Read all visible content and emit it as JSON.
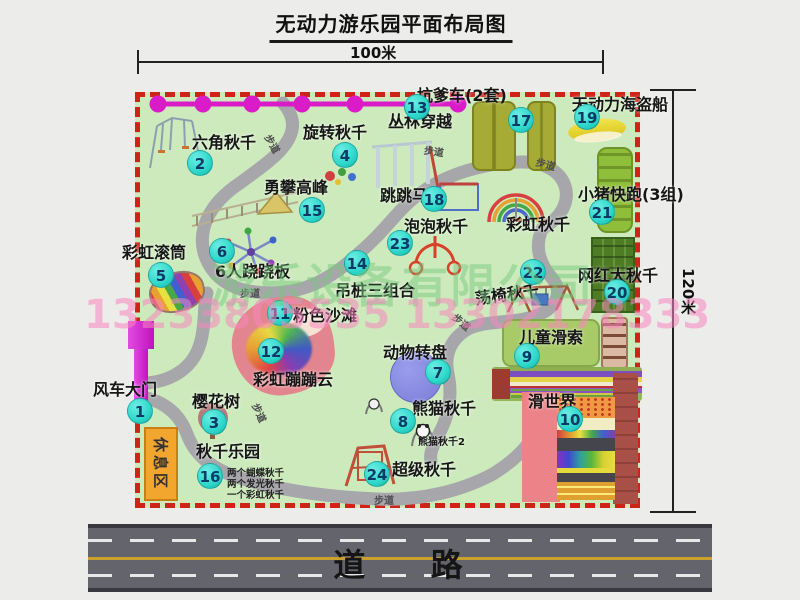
{
  "title": "无动力游乐园平面布局图",
  "dimensions": {
    "width": "100米",
    "height": "120米"
  },
  "road": {
    "label": "道 路"
  },
  "walkway_label": "步道",
  "watermark": {
    "company": "游乐设备有限公司",
    "phones": "13233805535 13302178333"
  },
  "rest_area": {
    "label": "休息区"
  },
  "colors": {
    "park_green": "#cdeabd",
    "border_red": "#cf2318",
    "badge_bg": "#2ed7cb",
    "badge_text": "#0a3a66",
    "road_gray": "#64646c",
    "magenta": "#da1cc8",
    "rest_orange": "#f2a62e",
    "walkway_gray": "#a7a7ab"
  },
  "pois": [
    {
      "id": "windmill-gate",
      "num": "1",
      "label": "风车大门"
    },
    {
      "id": "hex-swing",
      "num": "2",
      "label": "六角秋千"
    },
    {
      "id": "cherry-tree",
      "num": "3",
      "label": "樱花树"
    },
    {
      "id": "spin-swing",
      "num": "4",
      "label": "旋转秋千"
    },
    {
      "id": "rainbow-roller",
      "num": "5",
      "label": "彩虹滚筒"
    },
    {
      "id": "seesaw-6p",
      "num": "6",
      "label": "6人跷跷板"
    },
    {
      "id": "animal-turntable",
      "num": "7",
      "label": "动物转盘"
    },
    {
      "id": "panda-swing",
      "num": "8",
      "label": "熊猫秋千"
    },
    {
      "id": "kids-zipline",
      "num": "9",
      "label": "儿童滑索"
    },
    {
      "id": "slide-world",
      "num": "10",
      "label": "滑世界"
    },
    {
      "id": "pink-beach",
      "num": "11",
      "label": "粉色沙滩"
    },
    {
      "id": "rainbow-cloud",
      "num": "12",
      "label": "彩虹蹦蹦云"
    },
    {
      "id": "jungle-crossing",
      "num": "13",
      "label": "丛林穿越"
    },
    {
      "id": "hanging-posts",
      "num": "14",
      "label": "吊桩三组合"
    },
    {
      "id": "brave-climb",
      "num": "15",
      "label": "勇攀高峰"
    },
    {
      "id": "swing-park",
      "num": "16",
      "label": "秋千乐园",
      "notes": [
        "两个蝴蝶秋千",
        "两个发光秋千",
        "一个彩虹秋千"
      ]
    },
    {
      "id": "pit-cars",
      "num": "17",
      "label": "坑爹车(2套)"
    },
    {
      "id": "jump-horse",
      "num": "18",
      "label": "跳跳马"
    },
    {
      "id": "pirate-ship",
      "num": "19",
      "label": "无动力海盗船"
    },
    {
      "id": "big-swing",
      "num": "20",
      "label": "网红大秋千"
    },
    {
      "id": "pig-run",
      "num": "21",
      "label": "小猪快跑(3组)"
    },
    {
      "id": "chair-swing",
      "num": "22",
      "label": "荡椅秋千"
    },
    {
      "id": "bubble-swing",
      "num": "23",
      "label": "泡泡秋千"
    },
    {
      "id": "super-swing",
      "num": "24",
      "label": "超级秋千"
    },
    {
      "id": "rainbow-swing",
      "num": "",
      "label": "彩虹秋千"
    },
    {
      "id": "panda-swing-2",
      "num": "",
      "label": "熊猫秋千2",
      "small": true
    }
  ]
}
